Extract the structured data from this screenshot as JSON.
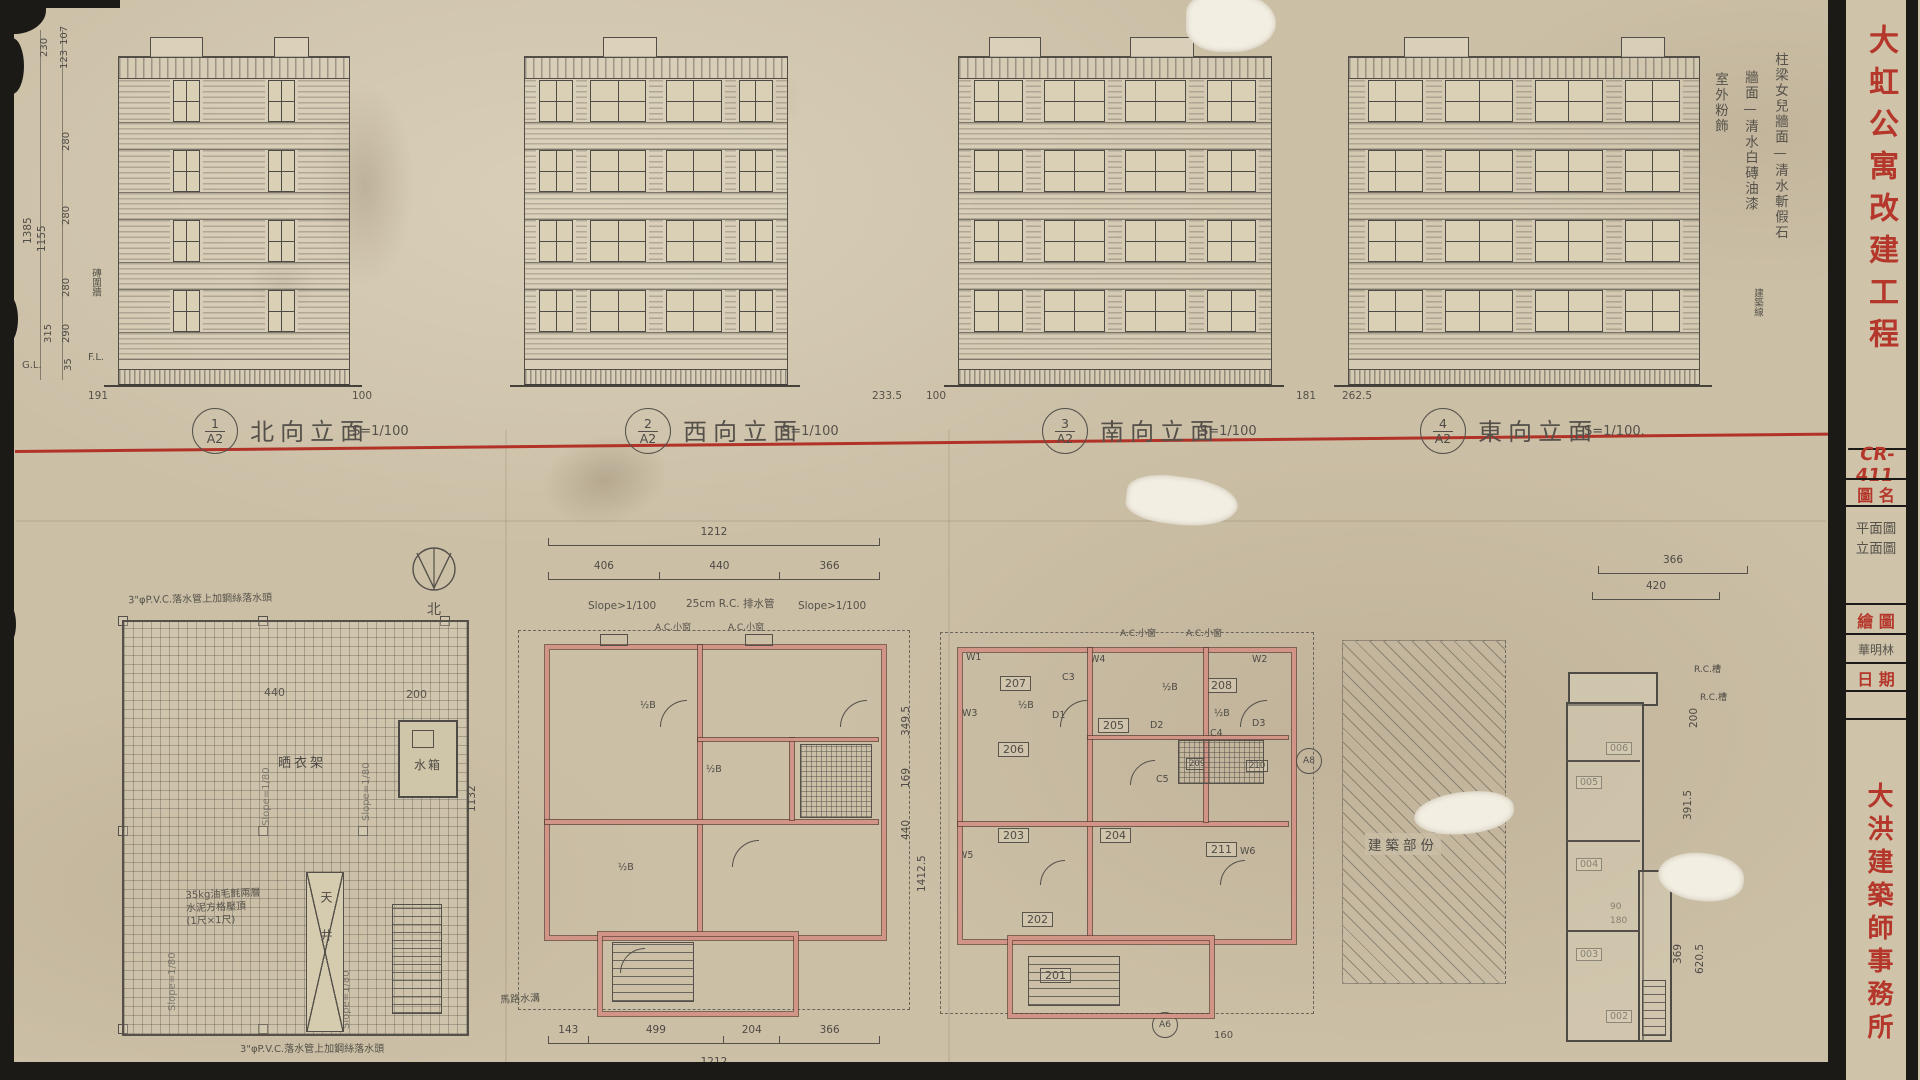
{
  "palette": {
    "red": "#b5362b",
    "pencil": "#56524a",
    "ink": "#4e4a45",
    "paper": "#cbbfa6",
    "wall_pink": "#d29486"
  },
  "title_block": {
    "project": "大虹公寓改建工程",
    "drawing_no": "CR-411",
    "field_drawing_name_label": "圖 名",
    "drawing_names": [
      "平面圖",
      "立面圖"
    ],
    "field_drawn_label": "繪 圖",
    "drawn_signature": "華明林",
    "field_date_label": "日 期",
    "office": "大洪建築師事務所"
  },
  "elevations": [
    {
      "num": "1",
      "sheet_ref": "A2",
      "name": "北向立面",
      "scale": "S=1/100",
      "base_dims": [
        "191",
        "100"
      ]
    },
    {
      "num": "2",
      "sheet_ref": "A2",
      "name": "西向立面",
      "scale": "S=1/100",
      "base_dims": []
    },
    {
      "num": "3",
      "sheet_ref": "A2",
      "name": "南向立面",
      "scale": "S=1/100",
      "base_dims": [
        "233.5",
        "100"
      ]
    },
    {
      "num": "4",
      "sheet_ref": "A2",
      "name": "東向立面",
      "scale": "S=1/100.",
      "base_dims": [
        "181",
        "262.5"
      ]
    }
  ],
  "finish_notes": [
    "柱梁女兒牆面—清水斬假石",
    "牆面—清水白磚油漆",
    "室外粉飾"
  ],
  "side_notes": {
    "building_line": "建築線",
    "brick_wall": "磚圍牆"
  },
  "left_dims": {
    "segments": [
      "107",
      "123",
      "230",
      "280",
      "280",
      "280",
      "290",
      "315",
      "35"
    ],
    "totals": [
      "1385",
      "1155"
    ],
    "gl": "G.L.",
    "fl": "F.L."
  },
  "north_label": "北",
  "roof_plan": {
    "drying": "晒衣架",
    "tank": "水箱",
    "lightwell": "天井",
    "slope": "Slope=1/80",
    "pvc_note": "3\"φP.V.C.落水管上加鋼絲落水頭",
    "felt_note_lines": [
      "35kg油毛氈兩層",
      "水泥方格壓頂",
      "(1尺×1尺)"
    ],
    "dims_top": [
      "440",
      "200"
    ],
    "dim_right": "1132"
  },
  "plan_3f": {
    "total_top": "1212",
    "top_segments": [
      "406",
      "440",
      "366"
    ],
    "slope_note_left": "Slope>1/100",
    "drain_note": "25cm R.C. 排水管",
    "slope_note_right": "Slope>1/100",
    "ac_note": "A.C.小窗",
    "half_b": "½B",
    "bottom_segments": [
      "143",
      "499",
      "204",
      "366"
    ],
    "total_bottom": "1212",
    "gutter_note": "馬路水溝",
    "right_dims": [
      "349.5",
      "169",
      "440",
      "1412.5"
    ]
  },
  "plan_2f": {
    "rooms": [
      "207",
      "205",
      "206",
      "208",
      "203",
      "204",
      "202",
      "201",
      "211",
      "209",
      "210"
    ],
    "wall_marks": [
      "W1",
      "W2",
      "W3",
      "W4",
      "W5",
      "W6"
    ],
    "door_marks": [
      "D1",
      "D2",
      "D3"
    ],
    "closet_marks": [
      "C3",
      "C4",
      "C5"
    ],
    "half_b": "½B",
    "ac_note": "A.C.小窗",
    "section_circles": [
      "A8",
      "A6"
    ],
    "bottom_dim": "160"
  },
  "hatched_plan": {
    "label": "建築部份"
  },
  "partial_plan": {
    "rooms": [
      "006",
      "005",
      "004",
      "003",
      "002"
    ],
    "dims_top": [
      "366",
      "420"
    ],
    "right_dims": [
      "200",
      "391.5",
      "369",
      "620.5"
    ],
    "inner_dims": [
      "90",
      "180"
    ],
    "gutter_note": "R.C.槽"
  }
}
